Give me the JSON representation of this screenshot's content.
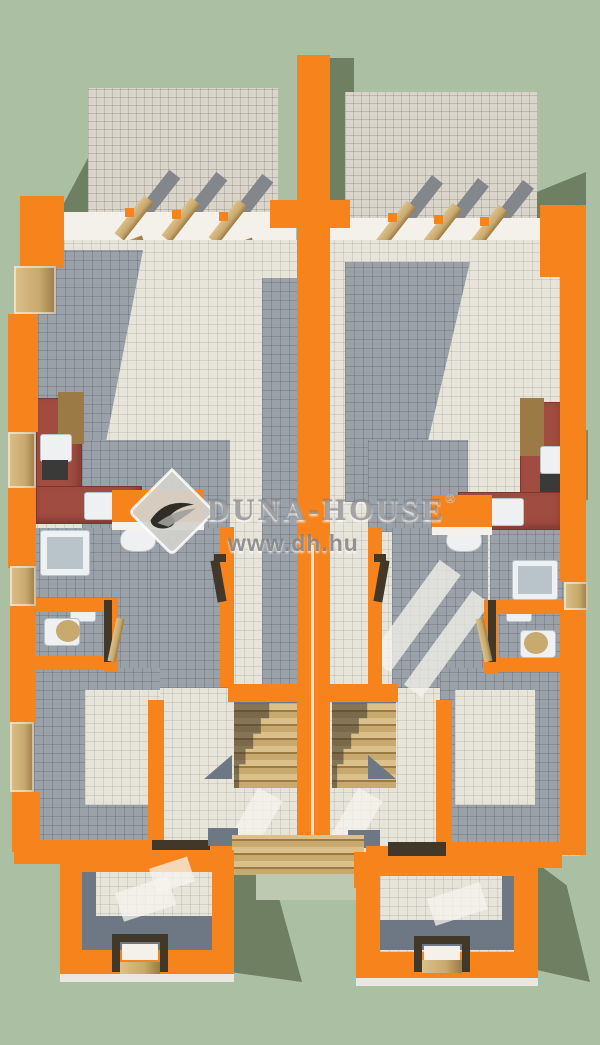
{
  "scene": {
    "description": "3D bird's-eye architectural render of a mirrored two-unit duplex floor plan with orange cut walls, tiled floors, kitchens, bathrooms, central staircases, rear terraces with pergola beams and front entrance porches on a green ground",
    "units": 2
  },
  "watermark": {
    "brand": "DUNA-HOUSE",
    "registered": "®",
    "url": "www.dh.hu",
    "logo": "duna-house-diamond-logo"
  },
  "colors": {
    "bg": "#abbfa2",
    "bgShadow": "#6e7f62",
    "orange": "#f6831c",
    "white": "#f3f1ea",
    "tileTerrace": "#d9d5ca",
    "tileLight": "#e7e4da",
    "tileGrey": "#9aa1a9",
    "slate": "#6e7884",
    "wood": "#c8a96e",
    "woodDark": "#9b7a46",
    "woodLight": "#dcc withoutfallback",
    "counterRed": "#a04c40",
    "counterRedDark": "#7c372e",
    "stove": "#3a3a38",
    "fixture": "#eef0f1",
    "fixtureShade": "#b9c3ca",
    "doorDark": "#42382a",
    "pad": "#bec9b2",
    "logoFill": "#d2d2cd",
    "logoDark": "#2e2d28"
  }
}
